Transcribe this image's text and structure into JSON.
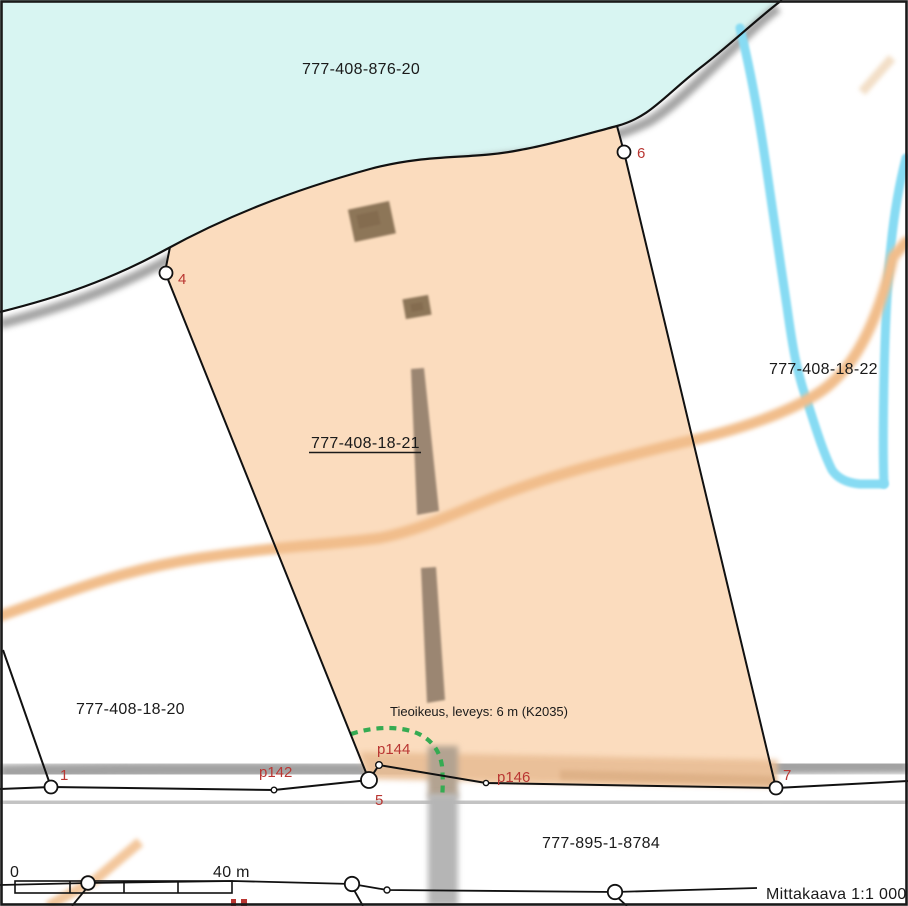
{
  "map": {
    "parcels": {
      "water": "777-408-876-20",
      "main": "777-408-18-21",
      "east": "777-408-18-22",
      "west": "777-408-18-20",
      "road": "777-895-1-8784"
    },
    "easement_note": "Tieoikeus, leveys: 6 m (K2035)",
    "points": [
      {
        "id": "1",
        "label": "1"
      },
      {
        "id": "4",
        "label": "4"
      },
      {
        "id": "5",
        "label": "5"
      },
      {
        "id": "6",
        "label": "6"
      },
      {
        "id": "7",
        "label": "7"
      },
      {
        "id": "p142",
        "label": "p142"
      },
      {
        "id": "p144",
        "label": "p144"
      },
      {
        "id": "p146",
        "label": "p146"
      }
    ],
    "scale_bar": {
      "zero": "0",
      "max": "40 m"
    },
    "scale_caption": "Mittakaava 1:1 000",
    "colors": {
      "water": "#D8F5F2",
      "parcel_fill": "#FBDCBE",
      "stream": "#87DBF3",
      "road_orange": "#F1BD8B",
      "label_red": "#B93632",
      "easement_green": "#35AB52",
      "road_gray": "#ACACAC",
      "path_brown": "#9B8672"
    }
  }
}
